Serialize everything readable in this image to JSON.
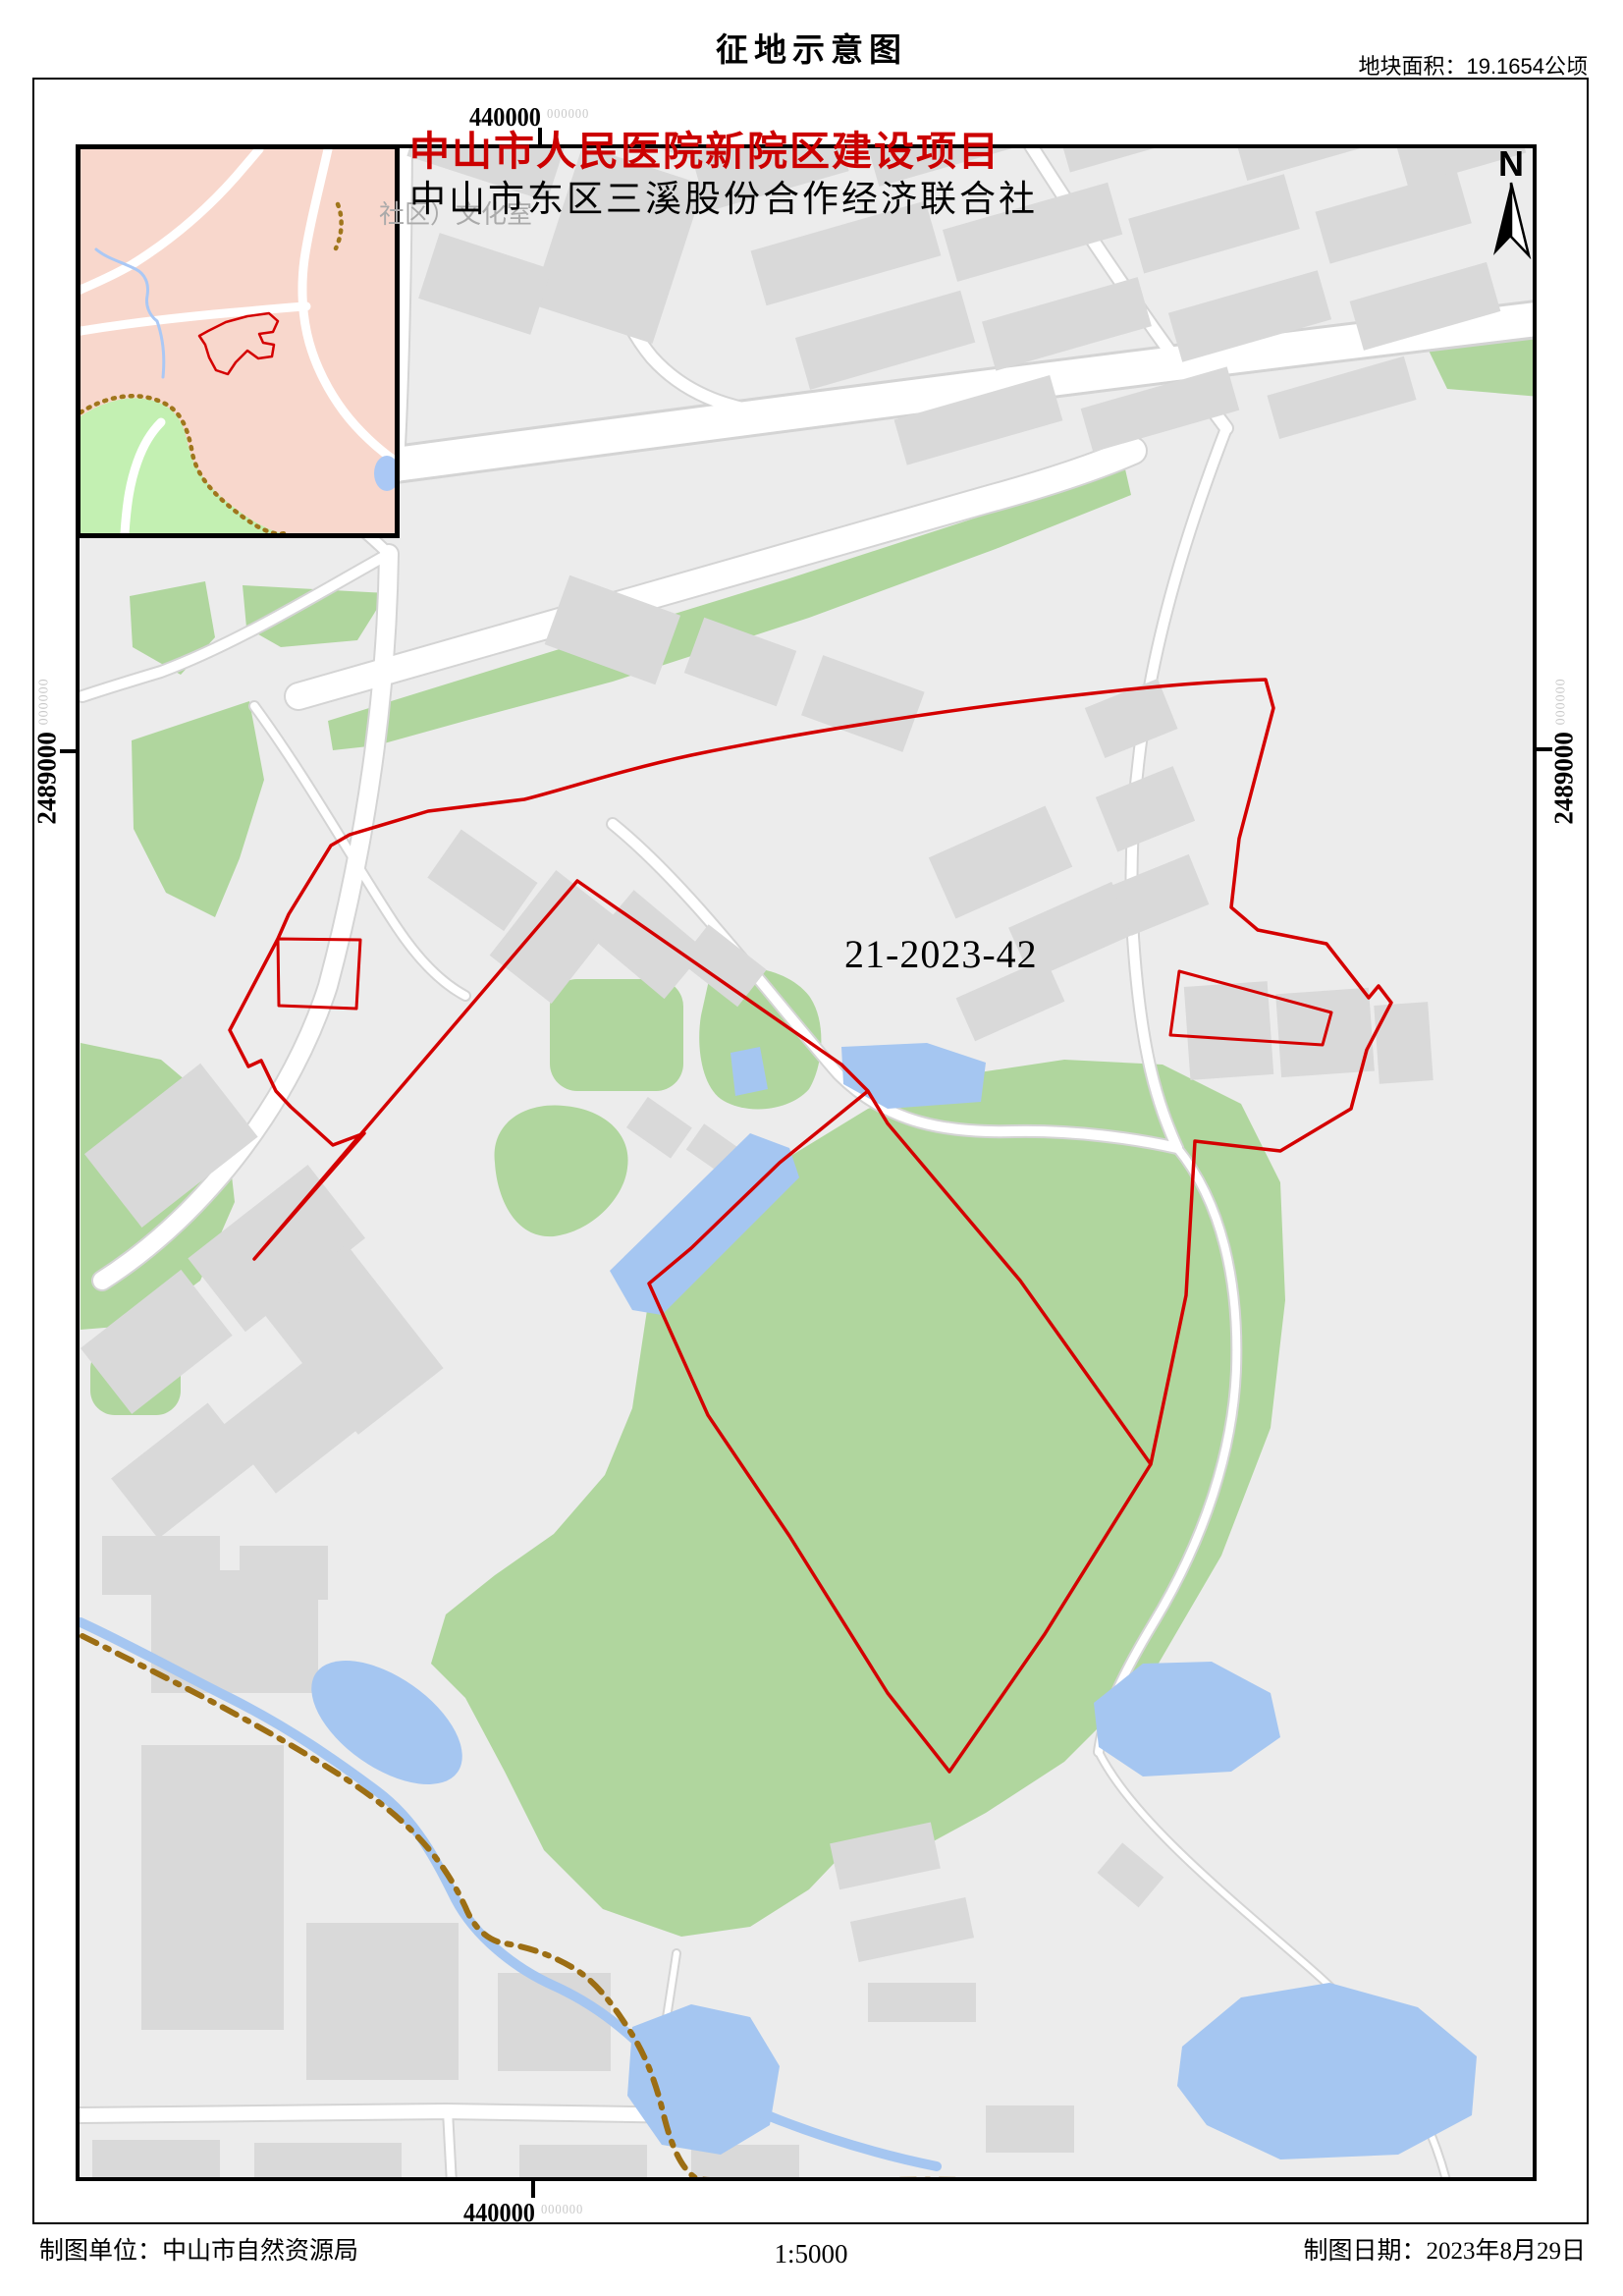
{
  "header": {
    "title": "征地示意图",
    "area_label": "地块面积：19.1654公顷"
  },
  "map": {
    "project_title": "中山市人民医院新院区建设项目",
    "org_label": "中山市东区三溪股份合作经济联合社",
    "poi_label": "社区）文化室",
    "parcel_id": "21-2023-42",
    "north_label": "N"
  },
  "coords": {
    "top": {
      "main": "440000",
      "sup": "000000"
    },
    "bottom": {
      "main": "440000",
      "sup": "000000"
    },
    "left": {
      "main": "2489000",
      "sup": "000000"
    },
    "right": {
      "main": "2489000",
      "sup": "000000"
    }
  },
  "footer": {
    "agency": "制图单位：中山市自然资源局",
    "scale": "1:5000",
    "date": "制图日期：2023年8月29日"
  },
  "colors": {
    "boundary_red": "#d40000",
    "green": "#b0d69e",
    "water": "#a5c6f1",
    "road": "#ffffff",
    "building": "#d9d9d9",
    "map_bg": "#ececec",
    "dirt_boundary_brown": "#9c6e14",
    "inset_pink": "#f8d7cc",
    "inset_green": "#c3f0b2"
  }
}
